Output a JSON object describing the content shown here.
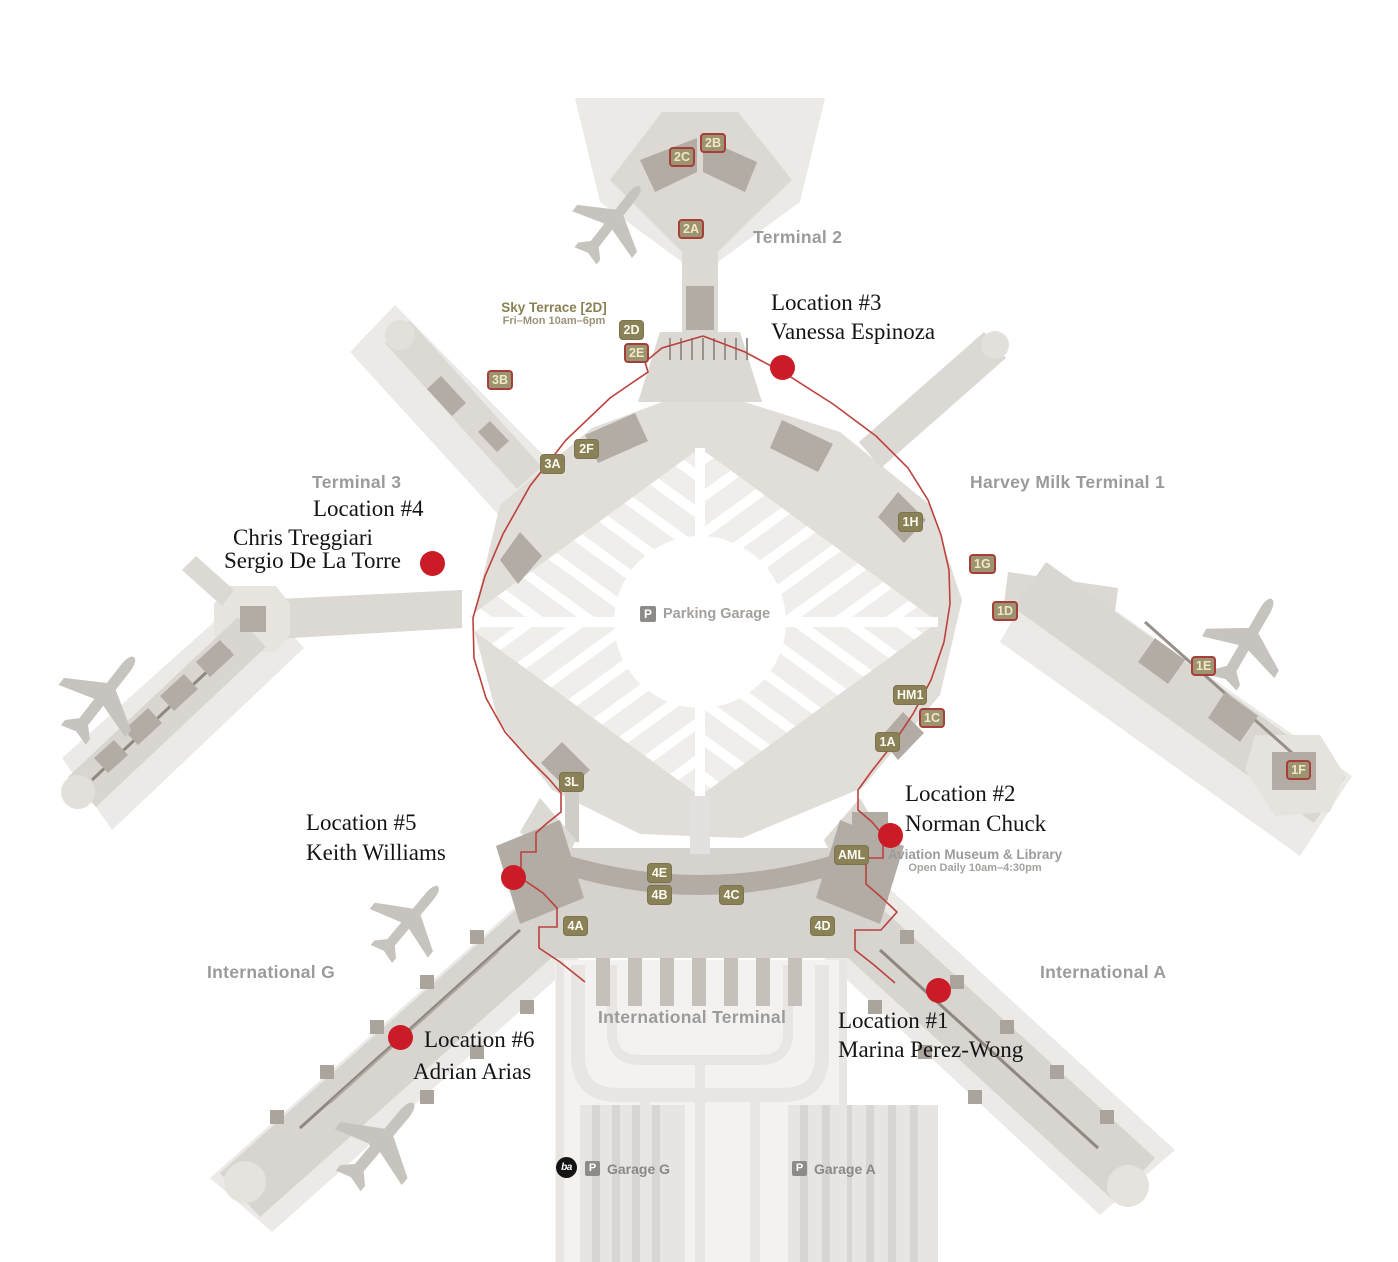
{
  "terminals": {
    "terminal2": "Terminal 2",
    "terminal3": "Terminal 3",
    "harvey_milk": "Harvey Milk Terminal 1",
    "international_g": "International G",
    "international_a": "International A",
    "international_terminal": "International Terminal"
  },
  "parking": {
    "icon": "P",
    "label": "Parking Garage"
  },
  "sky_terrace": {
    "title": "Sky Terrace [2D]",
    "hours": "Fri–Mon 10am–6pm"
  },
  "aviation_museum": {
    "title": "Aviation Museum & Library",
    "hours": "Open Daily 10am–4:30pm"
  },
  "garages": {
    "g": {
      "icon": "P",
      "label": "Garage G"
    },
    "a": {
      "icon": "P",
      "label": "Garage A"
    },
    "bart_icon": "ba"
  },
  "locations": [
    {
      "title": "Location #1",
      "line1": "Marina Perez-Wong"
    },
    {
      "title": "Location #2",
      "line1": "Norman Chuck"
    },
    {
      "title": "Location #3",
      "line1": "Vanessa Espinoza"
    },
    {
      "title": "Location #4",
      "line1": "Chris Treggiari",
      "line2": "Sergio De La Torre"
    },
    {
      "title": "Location #5",
      "line1": "Keith Williams"
    },
    {
      "title": "Location #6",
      "line1": "Adrian Arias"
    }
  ],
  "gates": [
    {
      "label": "2B",
      "style": "post-security"
    },
    {
      "label": "2C",
      "style": "post-security"
    },
    {
      "label": "2A",
      "style": "post-security"
    },
    {
      "label": "2D",
      "style": "pre-security"
    },
    {
      "label": "2E",
      "style": "post-security"
    },
    {
      "label": "3B",
      "style": "post-security"
    },
    {
      "label": "2F",
      "style": "pre-security"
    },
    {
      "label": "3A",
      "style": "pre-security"
    },
    {
      "label": "1H",
      "style": "pre-security"
    },
    {
      "label": "1G",
      "style": "post-security"
    },
    {
      "label": "1D",
      "style": "post-security"
    },
    {
      "label": "1E",
      "style": "post-security"
    },
    {
      "label": "HM1",
      "style": "pre-security"
    },
    {
      "label": "1C",
      "style": "post-security"
    },
    {
      "label": "1A",
      "style": "pre-security"
    },
    {
      "label": "1F",
      "style": "post-security"
    },
    {
      "label": "3L",
      "style": "pre-security"
    },
    {
      "label": "AML",
      "style": "pre-security"
    },
    {
      "label": "4E",
      "style": "pre-security"
    },
    {
      "label": "4B",
      "style": "pre-security"
    },
    {
      "label": "4C",
      "style": "pre-security"
    },
    {
      "label": "4A",
      "style": "pre-security"
    },
    {
      "label": "4D",
      "style": "pre-security"
    }
  ],
  "colors": {
    "marker_red": "#cb1b26",
    "secure_line_red": "#bb423d",
    "terminal_text_gray": "#9b9b9b",
    "olive": "#8a8054"
  }
}
